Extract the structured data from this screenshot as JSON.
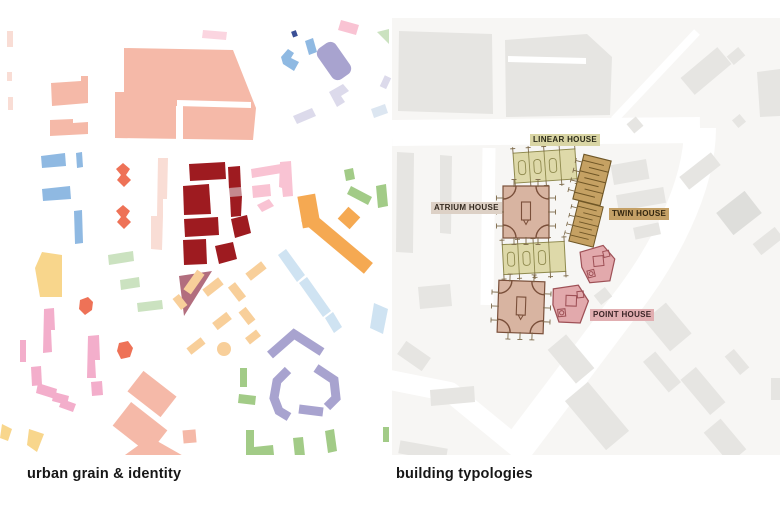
{
  "page": {
    "width": 780,
    "height": 512,
    "background": "#ffffff"
  },
  "panels": {
    "left": {
      "caption": "urban grain & identity"
    },
    "right": {
      "caption": "building typologies"
    }
  },
  "typologies": [
    {
      "id": "linear",
      "label": "LINEAR HOUSE",
      "chip_bg": "#d9d5a4",
      "text": "#2b2a18"
    },
    {
      "id": "atrium",
      "label": "ATRIUM HOUSE",
      "chip_bg": "#ddd1c6",
      "text": "#342a20"
    },
    {
      "id": "twin",
      "label": "TWIN HOUSE",
      "chip_bg": "#c4a066",
      "text": "#32250f"
    },
    {
      "id": "point",
      "label": "POINT HOUSE",
      "chip_bg": "#e1aeb1",
      "text": "#3c2527"
    }
  ],
  "colors": {
    "salmon": "#f5b9a8",
    "salmon-pale": "#f9ddd5",
    "dark-red": "#9e1b20",
    "red-muted": "#c4898f",
    "mauve": "#b26e7e",
    "pink-bright": "#f3aecb",
    "pink-light": "#f9c3d3",
    "coral": "#ee7257",
    "orange": "#f5a952",
    "orange-light": "#f8cf9a",
    "yellow": "#f8d68c",
    "blue": "#8fb9e2",
    "blue-light": "#cfe3f2",
    "blue-pale": "#dce6f1",
    "navy": "#3a4f96",
    "purple": "#a8a3cf",
    "purple-light": "#dcdaeb",
    "green": "#a2cb87",
    "green-light": "#cbe2c0",
    "map-base": "#f7f6f4",
    "map-building": "#e6e5e2",
    "map-building-dark": "#dededb",
    "road": "#ffffff",
    "linear-fill": "#ded9a9",
    "linear-stroke": "#8f8a4e",
    "atrium-fill": "#d8b4a1",
    "atrium-stroke": "#7a4f3a",
    "twin-fill": "#c5a163",
    "twin-stroke": "#6f5626",
    "point-fill": "#e2a9ac",
    "point-stroke": "#9e5056",
    "tick": "#7d6a4a",
    "caption": "#161616"
  }
}
